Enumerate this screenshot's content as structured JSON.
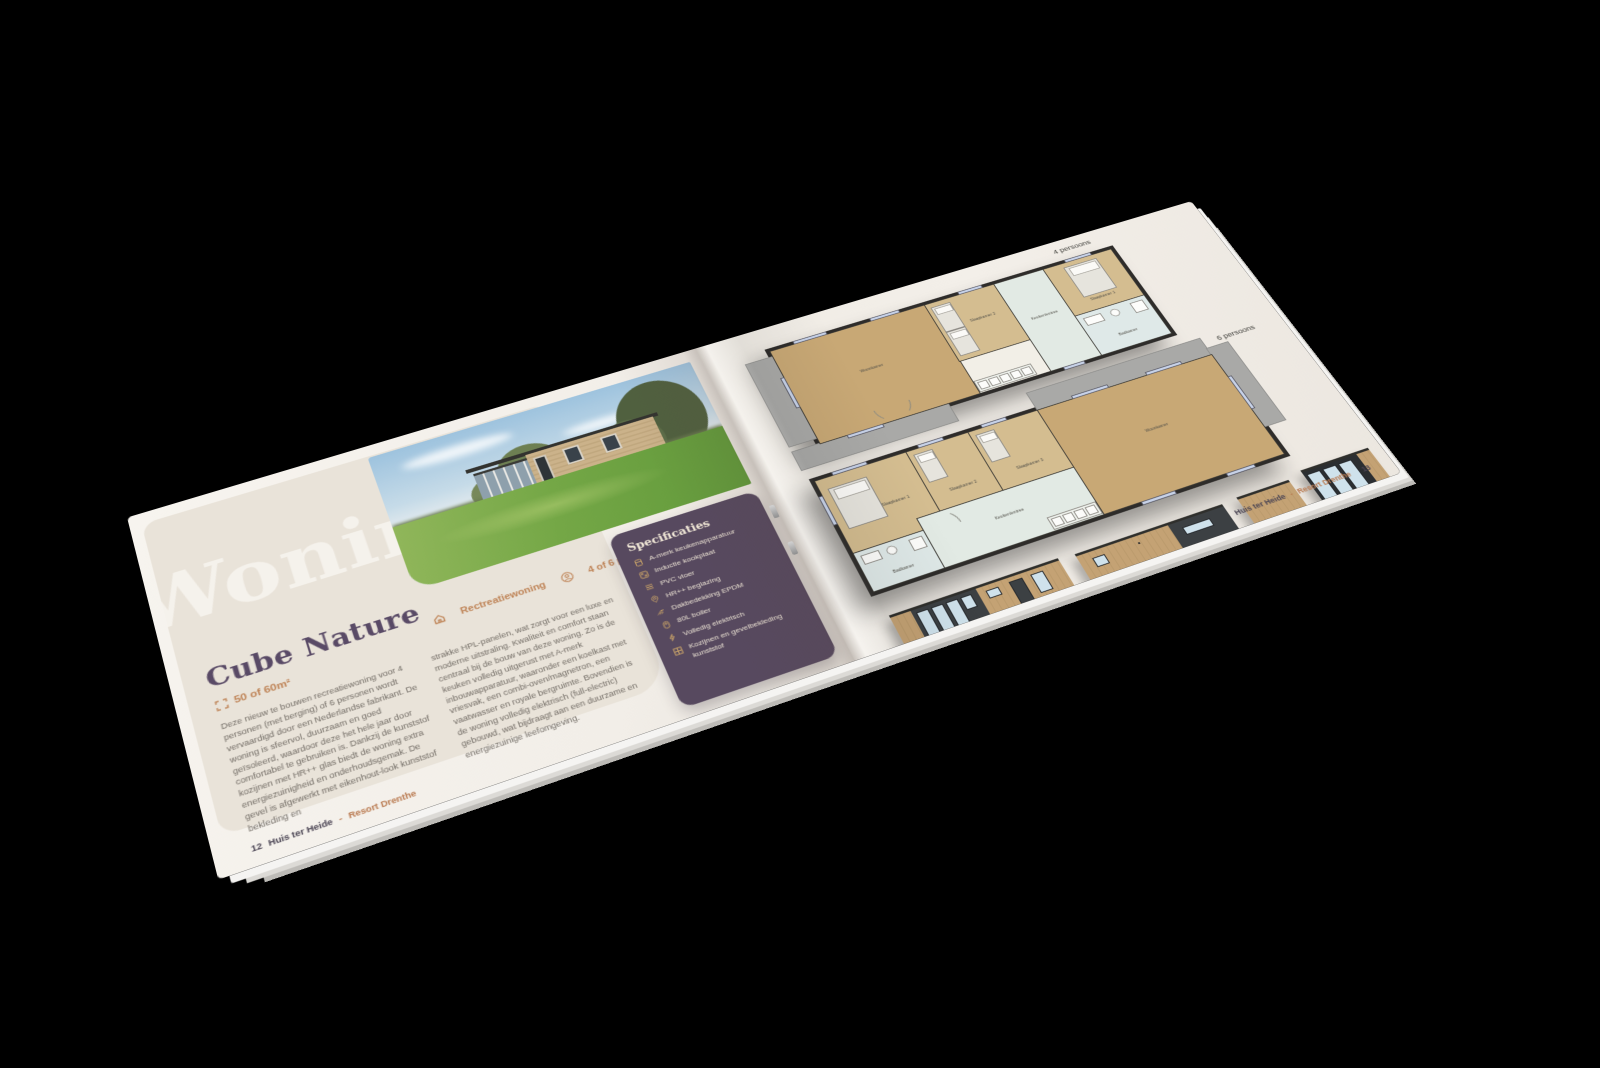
{
  "colors": {
    "accent_orange": "#bf8457",
    "heading_purple": "#594a66",
    "specs_background": "#57495f",
    "icon_gold": "#c9a368",
    "panel_beige": "#e9e3d9",
    "page_cream": "#f3efe9",
    "plan_wood_floor": "#c8a875",
    "plan_wet_room": "#dfe9e8",
    "plan_wall": "#2e2c2a"
  },
  "left_page": {
    "watermark": "Woningen",
    "title": "Cube Nature",
    "meta": {
      "size": "50 of 60m²",
      "type": "Rectreatiewoning",
      "persons": "4 of 6 persoons"
    },
    "body_col1": "Deze nieuw te bouwen recreatiewoning voor 4 personen (met berging) of 6 personen wordt vervaardigd door een Nederlandse fabrikant. De woning is sfeervol, duurzaam en goed geïsoleerd, waardoor deze het hele jaar door comfortabel te gebruiken is. Dankzij de kunststof kozijnen met HR++ glas biedt de woning extra energiezuinigheid en onderhoudsgemak. De gevel is afgewerkt met eikenhout-look kunststof bekleding en",
    "body_col2": "strakke HPL-panelen, wat zorgt voor een luxe en moderne uitstraling. Kwaliteit en comfort staan centraal bij de bouw van deze woning. Zo is de keuken volledig uitgerust met A-merk inbouwapparatuur, waaronder een koelkast met vriesvak, een combi-oven/magnetron, een vaatwasser en royale bergruimte. Bovendien is de woning volledig elektrisch (full-electric) gebouwd, wat bijdraagt aan een duurzame en energiezuinige leefomgeving.",
    "footer": {
      "page_number": "12",
      "brand": "Huis ter Heide",
      "separator": "-",
      "resort": "Resort Drenthe"
    }
  },
  "specs": {
    "title": "Specificaties",
    "items": [
      "A-merk keukenapparatuur",
      "Inductie kookplaat",
      "PVC vloer",
      "HR++ beglazing",
      "Dakbedekking EPDM",
      "80L boiler",
      "Volledig elektrisch",
      "Kozijnen en gevelbekleding kunststof"
    ]
  },
  "right_page": {
    "plans": [
      {
        "label": "4 persoons",
        "rooms": {
          "woonkamer": "Woonkamer",
          "slaapkamer1": "Slaapkamer 1",
          "slaapkamer2": "Slaapkamer 2",
          "badkamer": "Badkamer",
          "hal": "Keuken/entree"
        }
      },
      {
        "label": "6 persoons",
        "rooms": {
          "woonkamer": "Woonkamer",
          "slaapkamer1": "Slaapkamer 1",
          "slaapkamer2": "Slaapkamer 2",
          "slaapkamer3": "Slaapkamer 3",
          "badkamer": "Badkamer",
          "hal": "Keuken/entree"
        }
      }
    ],
    "footer": {
      "brand": "Huis ter Heide",
      "separator": "-",
      "resort": "Resort Drenthe",
      "page_number": "13"
    }
  }
}
